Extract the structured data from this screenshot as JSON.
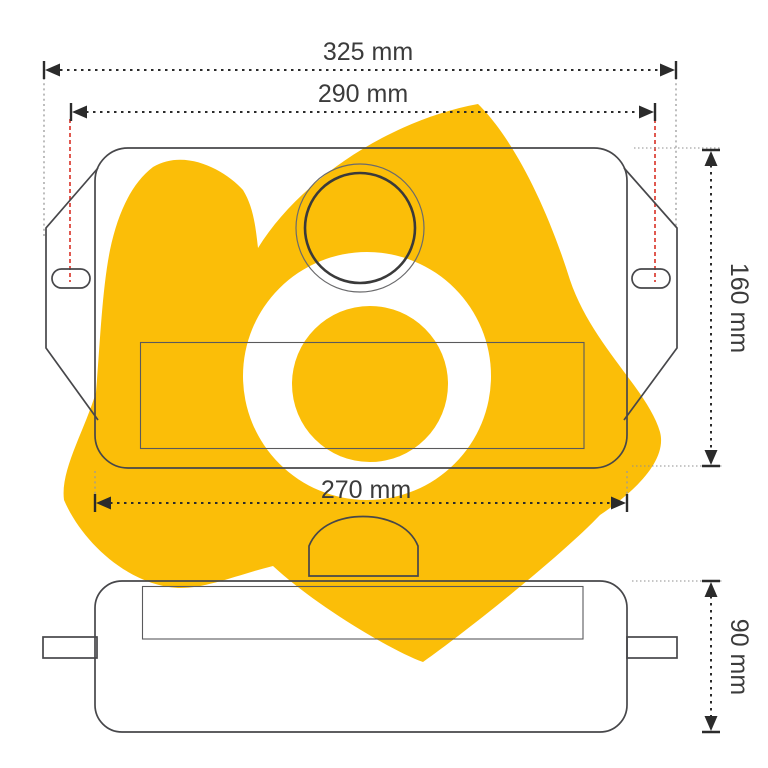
{
  "drawing": {
    "kind": "technical-dimension-drawing",
    "views": {
      "top_view": "tank top view with mounting ears, slots, filler cap and label plate",
      "side_view": "tank side view with side tabs and label plate"
    }
  },
  "dimensions": {
    "overall_width": {
      "label": "325 mm",
      "value": 325,
      "unit": "mm"
    },
    "slot_spacing": {
      "label": "290 mm",
      "value": 290,
      "unit": "mm"
    },
    "body_height": {
      "label": "160 mm",
      "value": 160,
      "unit": "mm"
    },
    "body_width": {
      "label": "270 mm",
      "value": 270,
      "unit": "mm"
    },
    "side_height": {
      "label": "90 mm",
      "value": 90,
      "unit": "mm"
    }
  },
  "colors": {
    "watermark_yellow": "#FBBE08",
    "ring_white": "#ffffff",
    "line_dark": "#47474a",
    "dimension_dark": "#2b2b2b",
    "extension_red": "#D93025",
    "text_gray": "#3b3b3b"
  }
}
